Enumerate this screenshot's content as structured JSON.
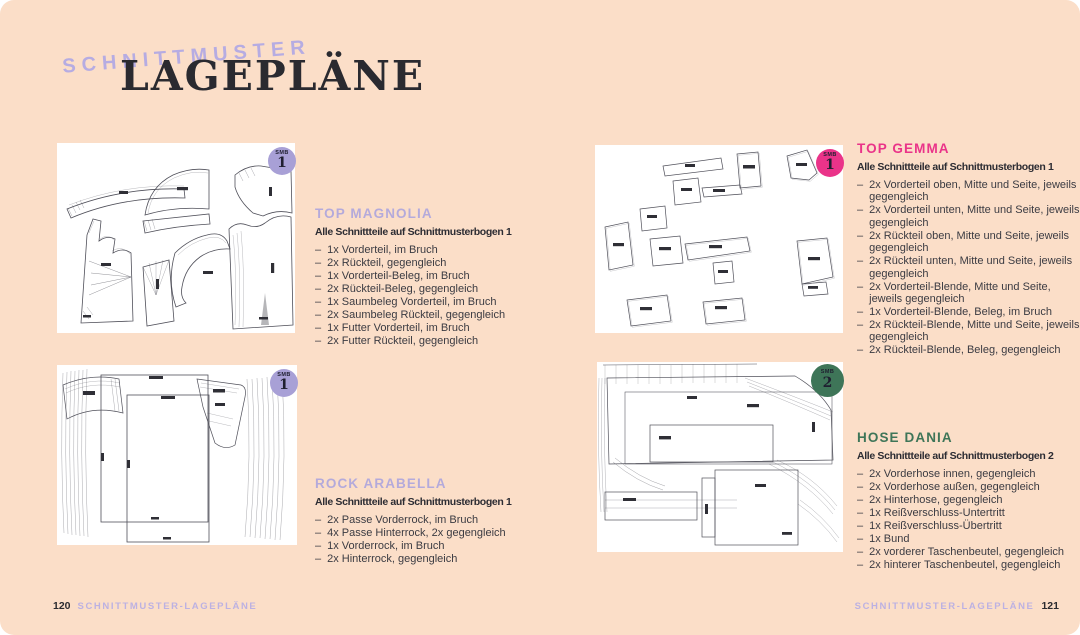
{
  "header": {
    "kicker": "SCHNITTMUSTER",
    "title": "LAGEPLÄNE"
  },
  "colors": {
    "background": "#fbdec8",
    "panel": "#ffffff",
    "lavender": "#b4aadb",
    "pink": "#ea3389",
    "green": "#3e7558",
    "ink": "#2a2a30",
    "badge_lavender": "#a8a0d6",
    "badge_pink": "#ea3389",
    "badge_green": "#3e7558"
  },
  "list_dash": "–",
  "sections": [
    {
      "title": "TOP MAGNOLIA",
      "title_color": "#b4aadb",
      "subtitle": "Alle Schnittteile auf Schnittmusterbogen 1",
      "badge": {
        "small": "SMB",
        "number": "1",
        "color": "#a8a0d6"
      },
      "items": [
        "1x Vorderteil, im Bruch",
        "2x Rückteil, gegengleich",
        "1x Vorderteil-Beleg, im Bruch",
        "2x Rückteil-Beleg, gegengleich",
        "1x Saumbeleg Vorderteil, im Bruch",
        "2x Saumbeleg Rückteil, gegengleich",
        "1x Futter Vorderteil, im Bruch",
        "2x Futter Rückteil, gegengleich"
      ]
    },
    {
      "title": "TOP GEMMA",
      "title_color": "#ea3389",
      "subtitle": "Alle Schnittteile auf Schnittmusterbogen 1",
      "badge": {
        "small": "SMB",
        "number": "1",
        "color": "#ea3389"
      },
      "items": [
        "2x Vorderteil oben, Mitte und Seite, jeweils gegengleich",
        "2x Vorderteil unten, Mitte und Seite, jeweils gegengleich",
        "2x Rückteil oben, Mitte und Seite, jeweils gegengleich",
        "2x Rückteil unten, Mitte und Seite, jeweils gegengleich",
        "2x Vorderteil-Blende, Mitte und Seite, jeweils gegengleich",
        "1x Vorderteil-Blende, Beleg, im Bruch",
        "2x Rückteil-Blende, Mitte und Seite, jeweils gegengleich",
        "2x Rückteil-Blende, Beleg, gegengleich"
      ]
    },
    {
      "title": "ROCK ARABELLA",
      "title_color": "#b4aadb",
      "subtitle": "Alle Schnittteile auf Schnittmusterbogen 1",
      "badge": {
        "small": "SMB",
        "number": "1",
        "color": "#a8a0d6"
      },
      "items": [
        "2x Passe Vorderrock, im Bruch",
        "4x Passe Hinterrock, 2x gegengleich",
        "1x Vorderrock, im Bruch",
        "2x Hinterrock, gegengleich"
      ]
    },
    {
      "title": "HOSE DANIA",
      "title_color": "#3e7558",
      "subtitle": "Alle Schnittteile auf Schnittmusterbogen 2",
      "badge": {
        "small": "SMB",
        "number": "2",
        "color": "#3e7558"
      },
      "items": [
        "2x Vorderhose innen, gegengleich",
        "2x Vorderhose außen, gegengleich",
        "2x Hinterhose, gegengleich",
        "1x Reißverschluss-Untertritt",
        "1x Reißverschluss-Übertritt",
        "1x Bund",
        "2x vorderer Taschenbeutel, gegengleich",
        "2x hinterer Taschenbeutel, gegengleich"
      ]
    }
  ],
  "footer": {
    "left": {
      "page_number": "120",
      "label": "SCHNITTMUSTER-LAGEPLÄNE"
    },
    "right": {
      "page_number": "121",
      "label": "SCHNITTMUSTER-LAGEPLÄNE"
    }
  }
}
